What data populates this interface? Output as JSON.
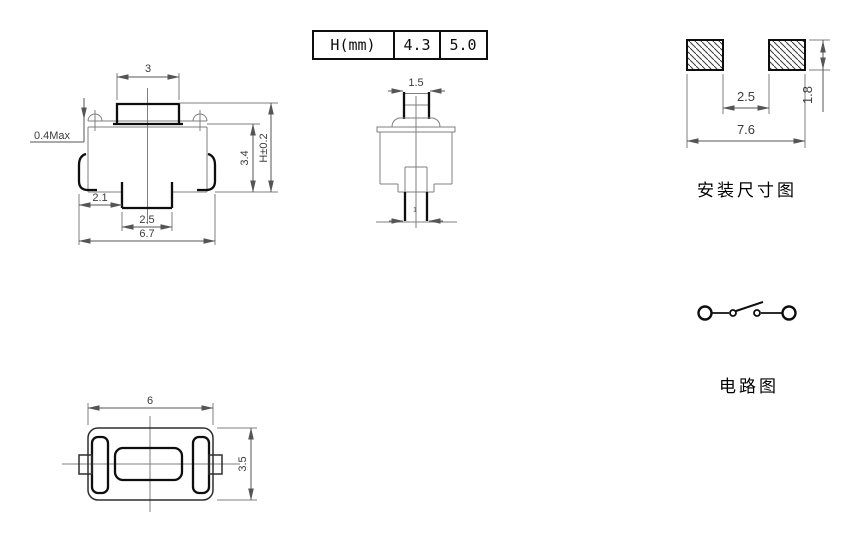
{
  "colors": {
    "background": "#ffffff",
    "line": "#0e0e0e",
    "dim": "#555555"
  },
  "front_view": {
    "dim_top_width": "3",
    "dim_press_max": "0.4Max",
    "dim_left_offset": "2.1",
    "dim_stem_width": "2.5",
    "dim_total_width": "6.7",
    "dim_body_height": "3.4",
    "dim_total_height": "H±0.2"
  },
  "height_table": {
    "header": "H(mm)",
    "option1": "4.3",
    "option2": "5.0"
  },
  "side_view": {
    "dim_button_width": "1.5",
    "dim_terminal_width": "1"
  },
  "mounting_view": {
    "dim_pad_gap": "2.5",
    "dim_total_span": "7.6",
    "dim_pad_height": "1.8",
    "caption": "安装尺寸图"
  },
  "circuit_view": {
    "caption": "电路图"
  },
  "bottom_view": {
    "dim_width": "6",
    "dim_height": "3.5"
  }
}
